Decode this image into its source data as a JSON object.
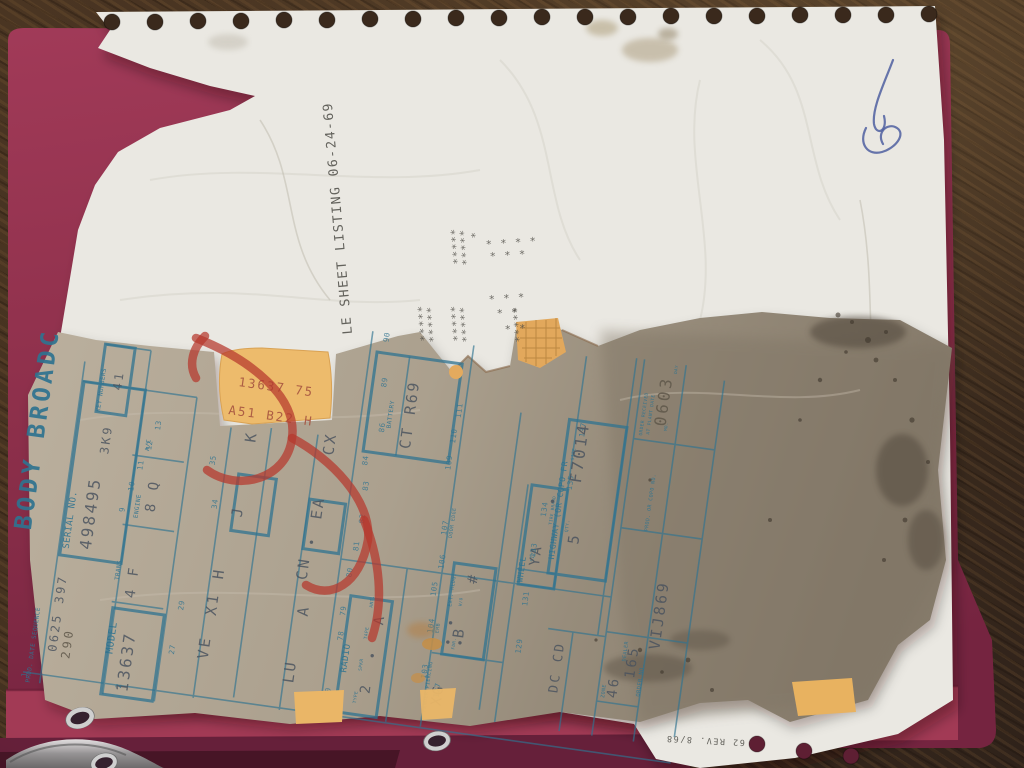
{
  "colors": {
    "wood": "#42301f",
    "folder": "#96334f",
    "folder_flap": "#a23a55",
    "folder_dark": "#66203a",
    "folder_deep": "#471526",
    "paper": "#eae8e2",
    "sheet": "#b9ae9c",
    "sheet_soiled": "#857a6a",
    "grid_blue": "#2f7390",
    "stamp_ink": "#49525e",
    "pencil": "#5f574a",
    "type_ink": "#4c4b45",
    "red_mark": "#b5372c",
    "orange_tag": "#edbb6c",
    "tag_ink": "#a5523f",
    "pen_blue": "#4f5fa0"
  },
  "document": {
    "type_line": "LE SHEET LISTING  06-24-69",
    "title_visible": "BODY BROADC",
    "serial_no": "498495",
    "key_numbers": "3K9 41",
    "prod_date_sequence": "0625 397",
    "model": "13637",
    "trans": "4 F",
    "engine": "8 Q",
    "battery": "CT R69",
    "radio": "2 A",
    "fender_piercing": "XG",
    "emb": "B",
    "wheel_size": "YA",
    "highway_qty": "5",
    "highway_size": "F7014",
    "order_received_date": "0603",
    "order_no": "VIJ869",
    "zone": "46",
    "dealer": "165",
    "dealer_code": "DC CD",
    "orange_tag_line1": "13637 75",
    "orange_tag_line2": "A51 B22 H",
    "form_revision": "62 REV. 8/68"
  },
  "items": [
    {
      "g": "s",
      "t": "BODY BROADC",
      "x": 34,
      "y": 575,
      "s": 24,
      "r": -90,
      "c": "t",
      "ls": 4,
      "n": "sheet-title"
    },
    {
      "g": "s",
      "t": "SERIAL NO.",
      "x": 74,
      "y": 588,
      "s": 9,
      "r": -90,
      "c": "l",
      "ls": 1,
      "n": "serial-label"
    },
    {
      "g": "s",
      "t": "498495",
      "x": 96,
      "y": 586,
      "s": 16,
      "r": -90,
      "c": "s",
      "ls": 12,
      "n": "serial-value"
    },
    {
      "g": "s",
      "t": "KEY NUMBERS",
      "x": 86,
      "y": 448,
      "s": 6,
      "r": -90,
      "c": "l"
    },
    {
      "g": "s",
      "t": "3K9",
      "x": 100,
      "y": 489,
      "s": 12,
      "r": -90,
      "c": "s",
      "ls": 6
    },
    {
      "g": "s",
      "t": "41",
      "x": 104,
      "y": 424,
      "s": 12,
      "r": -90,
      "c": "s",
      "ls": 6
    },
    {
      "g": "s",
      "t": "PROD. DATE SEQUENCE",
      "x": 54,
      "y": 726,
      "s": 6,
      "r": -90,
      "c": "l"
    },
    {
      "g": "s",
      "t": "0625 397",
      "x": 76,
      "y": 692,
      "s": 12,
      "r": -90,
      "c": "s",
      "ls": 7
    },
    {
      "g": "s",
      "t": "290",
      "x": 90,
      "y": 697,
      "s": 12,
      "r": -90,
      "c": "p"
    },
    {
      "g": "s",
      "t": "MODEL",
      "x": 132,
      "y": 686,
      "s": 10,
      "r": -90,
      "c": "l",
      "ls": 1.5,
      "n": "model-label"
    },
    {
      "g": "s",
      "t": "13637",
      "x": 152,
      "y": 722,
      "s": 16,
      "r": -90,
      "c": "s",
      "ls": 12,
      "n": "model-value"
    },
    {
      "g": "s",
      "t": "TRANS",
      "x": 128,
      "y": 612,
      "s": 6,
      "r": -90,
      "c": "l"
    },
    {
      "g": "s",
      "t": "4 F",
      "x": 146,
      "y": 628,
      "s": 14,
      "r": -90,
      "c": "s",
      "ls": 8
    },
    {
      "g": "s",
      "t": "ENGINE",
      "x": 138,
      "y": 548,
      "s": 6,
      "r": -90,
      "c": "l"
    },
    {
      "g": "s",
      "t": "8 Q",
      "x": 154,
      "y": 540,
      "s": 14,
      "r": -90,
      "c": "s",
      "ls": 8
    },
    {
      "g": "s",
      "t": "A/C",
      "x": 140,
      "y": 480,
      "s": 6,
      "r": -90,
      "c": "l"
    },
    {
      "g": "s",
      "t": "9",
      "x": 124,
      "y": 544,
      "s": 7.5,
      "r": -90,
      "c": "n"
    },
    {
      "g": "s",
      "t": "10",
      "x": 130,
      "y": 522,
      "s": 7.5,
      "r": -90,
      "c": "n"
    },
    {
      "g": "s",
      "t": "11",
      "x": 136,
      "y": 500,
      "s": 7.5,
      "r": -90,
      "c": "n"
    },
    {
      "g": "s",
      "t": "12",
      "x": 142,
      "y": 479,
      "s": 7.5,
      "r": -90,
      "c": "n"
    },
    {
      "g": "s",
      "t": "13",
      "x": 148,
      "y": 458,
      "s": 7.5,
      "r": -90,
      "c": "n"
    },
    {
      "g": "s",
      "t": "1",
      "x": 50,
      "y": 721,
      "s": 7.5,
      "r": -90,
      "c": "n"
    },
    {
      "g": "s",
      "t": "2",
      "x": 145,
      "y": 719,
      "s": 7.5,
      "r": -90,
      "c": "n"
    },
    {
      "g": "s",
      "t": "27",
      "x": 193,
      "y": 678,
      "s": 7.5,
      "r": -90,
      "c": "n"
    },
    {
      "g": "s",
      "t": "29",
      "x": 196,
      "y": 633,
      "s": 7.5,
      "r": -90,
      "c": "n"
    },
    {
      "g": "s",
      "t": "34",
      "x": 215,
      "y": 528,
      "s": 7.5,
      "r": -90,
      "c": "n"
    },
    {
      "g": "s",
      "t": "35",
      "x": 207,
      "y": 485,
      "s": 7.5,
      "r": -90,
      "c": "n"
    },
    {
      "g": "s",
      "t": "VE",
      "x": 227,
      "y": 678,
      "s": 15,
      "r": -90,
      "c": "s",
      "ls": 6
    },
    {
      "g": "s",
      "t": "X1",
      "x": 229,
      "y": 634,
      "s": 15,
      "r": -90,
      "c": "s",
      "ls": 6
    },
    {
      "g": "s",
      "t": "H",
      "x": 231,
      "y": 597,
      "s": 15,
      "r": -90,
      "c": "s"
    },
    {
      "g": "s",
      "t": "J",
      "x": 241,
      "y": 533,
      "s": 15,
      "r": -90,
      "c": "s"
    },
    {
      "g": "s",
      "t": "K",
      "x": 244,
      "y": 457,
      "s": 15,
      "r": -90,
      "c": "s"
    },
    {
      "g": "s",
      "t": "LU",
      "x": 315,
      "y": 690,
      "s": 15,
      "r": -90,
      "c": "s",
      "ls": 6
    },
    {
      "g": "s",
      "t": "A",
      "x": 320,
      "y": 622,
      "s": 15,
      "r": -90,
      "c": "s"
    },
    {
      "g": "s",
      "t": "CN",
      "x": 314,
      "y": 586,
      "s": 15,
      "r": -90,
      "c": "s",
      "ls": 6
    },
    {
      "g": "s",
      "t": "•",
      "x": 318,
      "y": 551,
      "s": 12,
      "r": -90,
      "c": "s"
    },
    {
      "g": "s",
      "t": "EA",
      "x": 320,
      "y": 524,
      "s": 15,
      "r": -90,
      "c": "s",
      "ls": 6
    },
    {
      "g": "s",
      "t": "CX",
      "x": 323,
      "y": 459,
      "s": 15,
      "r": -90,
      "c": "s",
      "ls": 6
    },
    {
      "g": "s",
      "t": "BATTERY",
      "x": 376,
      "y": 424,
      "s": 6,
      "r": -90,
      "c": "l"
    },
    {
      "g": "s",
      "t": "CT R69",
      "x": 398,
      "y": 442,
      "s": 15,
      "r": -90,
      "c": "s",
      "ls": 5,
      "n": "battery-value"
    },
    {
      "g": "s",
      "t": "90",
      "x": 362,
      "y": 339,
      "s": 7.5,
      "r": -90,
      "c": "n"
    },
    {
      "g": "s",
      "t": "89",
      "x": 366,
      "y": 384,
      "s": 7.5,
      "r": -90,
      "c": "n"
    },
    {
      "g": "s",
      "t": "86",
      "x": 370,
      "y": 429,
      "s": 7.5,
      "r": -90,
      "c": "n"
    },
    {
      "g": "s",
      "t": "84",
      "x": 358,
      "y": 464,
      "s": 7.5,
      "r": -90,
      "c": "n"
    },
    {
      "g": "s",
      "t": "83",
      "x": 362,
      "y": 489,
      "s": 7.5,
      "r": -90,
      "c": "n"
    },
    {
      "g": "s",
      "t": "82",
      "x": 363,
      "y": 522,
      "s": 7.5,
      "r": -90,
      "c": "n"
    },
    {
      "g": "s",
      "t": "81",
      "x": 361,
      "y": 550,
      "s": 7.5,
      "r": -90,
      "c": "n"
    },
    {
      "g": "s",
      "t": "80",
      "x": 358,
      "y": 577,
      "s": 7.5,
      "r": -90,
      "c": "n"
    },
    {
      "g": "s",
      "t": "79",
      "x": 357,
      "y": 616,
      "s": 7.5,
      "r": -90,
      "c": "n"
    },
    {
      "g": "s",
      "t": "78",
      "x": 358,
      "y": 641,
      "s": 7.5,
      "r": -90,
      "c": "n"
    },
    {
      "g": "s",
      "t": "70",
      "x": 353,
      "y": 699,
      "s": 7.5,
      "r": -90,
      "c": "n"
    },
    {
      "g": "s",
      "t": "111",
      "x": 444,
      "y": 404,
      "s": 7.5,
      "r": -90,
      "c": "n"
    },
    {
      "g": "s",
      "t": "110",
      "x": 442,
      "y": 430,
      "s": 7.5,
      "r": -90,
      "c": "n"
    },
    {
      "g": "s",
      "t": "109",
      "x": 441,
      "y": 457,
      "s": 7.5,
      "r": -90,
      "c": "n"
    },
    {
      "g": "s",
      "t": "107",
      "x": 446,
      "y": 522,
      "s": 7.5,
      "r": -90,
      "c": "n"
    },
    {
      "g": "s",
      "t": "106",
      "x": 448,
      "y": 556,
      "s": 7.5,
      "r": -90,
      "c": "n"
    },
    {
      "g": "s",
      "t": "105",
      "x": 444,
      "y": 584,
      "s": 7.5,
      "r": -90,
      "c": "n"
    },
    {
      "g": "s",
      "t": "104",
      "x": 446,
      "y": 621,
      "s": 7.5,
      "r": -90,
      "c": "n"
    },
    {
      "g": "s",
      "t": "103",
      "x": 446,
      "y": 667,
      "s": 7.5,
      "r": -90,
      "c": "n"
    },
    {
      "g": "s",
      "t": "DOOR EDGE",
      "x": 452,
      "y": 524,
      "s": 5,
      "r": -90,
      "c": "l"
    },
    {
      "g": "s",
      "t": "RADIO",
      "x": 366,
      "y": 672,
      "s": 9,
      "r": -90,
      "c": "l",
      "ls": 1.5,
      "n": "radio-label"
    },
    {
      "g": "s",
      "t": "TYPE",
      "x": 380,
      "y": 701,
      "s": 4.5,
      "r": -90,
      "c": "l"
    },
    {
      "g": "s",
      "t": "SPKR",
      "x": 381,
      "y": 668,
      "s": 4.5,
      "r": -90,
      "c": "l"
    },
    {
      "g": "s",
      "t": "TAPE",
      "x": 382,
      "y": 636,
      "s": 4.5,
      "r": -90,
      "c": "l"
    },
    {
      "g": "s",
      "t": "ANT.",
      "x": 383,
      "y": 604,
      "s": 4.5,
      "r": -90,
      "c": "l"
    },
    {
      "g": "s",
      "t": "2",
      "x": 392,
      "y": 690,
      "s": 14,
      "r": -90,
      "c": "s"
    },
    {
      "g": "s",
      "t": "•",
      "x": 394,
      "y": 655,
      "s": 12,
      "r": -90,
      "c": "s"
    },
    {
      "g": "s",
      "t": "A",
      "x": 396,
      "y": 620,
      "s": 14,
      "r": -90,
      "c": "s"
    },
    {
      "g": "s",
      "t": "FENDER PIERCING",
      "x": 450,
      "y": 700,
      "s": 5,
      "r": -90,
      "c": "l"
    },
    {
      "g": "s",
      "t": "XG",
      "x": 464,
      "y": 692,
      "s": 14,
      "r": -90,
      "c": "s",
      "ls": 6
    },
    {
      "g": "s",
      "t": "• •",
      "x": 467,
      "y": 631,
      "s": 12,
      "r": -90,
      "c": "s",
      "ls": 6
    },
    {
      "g": "s",
      "t": "EMB",
      "x": 452,
      "y": 620,
      "s": 5,
      "r": -90,
      "c": "l"
    },
    {
      "g": "s",
      "t": "B",
      "x": 477,
      "y": 622,
      "s": 15,
      "r": -90,
      "c": "s"
    },
    {
      "g": "s",
      "t": "EXT. MLDG.",
      "x": 461,
      "y": 592,
      "s": 5,
      "r": -90,
      "c": "l"
    },
    {
      "g": "s",
      "t": "FDR.",
      "x": 470,
      "y": 634,
      "s": 4.2,
      "r": -90,
      "c": "l"
    },
    {
      "g": "s",
      "t": "W/O",
      "x": 471,
      "y": 590,
      "s": 4.2,
      "r": -90,
      "c": "l"
    },
    {
      "g": "s",
      "t": "•",
      "x": 479,
      "y": 630,
      "s": 12,
      "r": -90,
      "c": "s"
    },
    {
      "g": "s",
      "t": "#",
      "x": 483,
      "y": 566,
      "s": 14,
      "r": -90,
      "c": "s"
    },
    {
      "g": "s",
      "t": "WHEEL",
      "x": 528,
      "y": 558,
      "s": 8,
      "r": -90,
      "c": "l",
      "ls": 1
    },
    {
      "g": "s",
      "t": "SIZE",
      "x": 536,
      "y": 536,
      "s": 4.5,
      "r": -90,
      "c": "l"
    },
    {
      "g": "s",
      "t": "YA",
      "x": 542,
      "y": 540,
      "s": 14,
      "r": -90,
      "c": "s",
      "ls": 6
    },
    {
      "g": "s",
      "t": "TIRE BRAND",
      "x": 549,
      "y": 497,
      "s": 4.2,
      "r": -90,
      "c": "l"
    },
    {
      "g": "s",
      "t": "•",
      "x": 551,
      "y": 477,
      "s": 12,
      "r": -90,
      "c": "s"
    },
    {
      "g": "s",
      "t": "137",
      "x": 569,
      "y": 406,
      "s": 7.5,
      "r": -90,
      "c": "n"
    },
    {
      "g": "s",
      "t": "135",
      "x": 564,
      "y": 460,
      "s": 7.5,
      "r": -90,
      "c": "n"
    },
    {
      "g": "s",
      "t": "134",
      "x": 542,
      "y": 490,
      "s": 7.5,
      "r": -90,
      "c": "n"
    },
    {
      "g": "s",
      "t": "133",
      "x": 537,
      "y": 532,
      "s": 7.5,
      "r": -90,
      "c": "n"
    },
    {
      "g": "s",
      "t": "131",
      "x": 536,
      "y": 581,
      "s": 7.5,
      "r": -90,
      "c": "n"
    },
    {
      "g": "s",
      "t": "129",
      "x": 536,
      "y": 629,
      "s": 7.5,
      "r": -90,
      "c": "n"
    },
    {
      "g": "s",
      "t": "127",
      "x": 461,
      "y": 684,
      "s": 7.5,
      "r": -90,
      "c": "n"
    },
    {
      "g": "s",
      "t": "HIGHWAY (OR COPO FR",
      "x": 556,
      "y": 531,
      "s": 8,
      "r": -90,
      "c": "l",
      "n": "highway-label"
    },
    {
      "g": "s",
      "t": "QTY.",
      "x": 566,
      "y": 502,
      "s": 4.5,
      "r": -90,
      "c": "l"
    },
    {
      "g": "s",
      "t": "5",
      "x": 578,
      "y": 513,
      "s": 15,
      "r": -90,
      "c": "s"
    },
    {
      "g": "s",
      "t": "SIZE",
      "x": 562,
      "y": 430,
      "s": 4.5,
      "r": -90,
      "c": "l"
    },
    {
      "g": "s",
      "t": "F7014",
      "x": 572,
      "y": 452,
      "s": 16,
      "r": -90,
      "c": "s",
      "ls": 12,
      "n": "highway-size-value"
    },
    {
      "g": "s",
      "t": "ORDER RECEIVED",
      "x": 626,
      "y": 396,
      "s": 4.5,
      "r": -90,
      "c": "l"
    },
    {
      "g": "s",
      "t": "AT PLANT DATE",
      "x": 633,
      "y": 394,
      "s": 4.5,
      "r": -90,
      "c": "l"
    },
    {
      "g": "s",
      "t": "MO.",
      "x": 650,
      "y": 388,
      "s": 4.2,
      "r": -90,
      "c": "l"
    },
    {
      "g": "s",
      "t": "DAY",
      "x": 652,
      "y": 330,
      "s": 4.2,
      "r": -90,
      "c": "l"
    },
    {
      "g": "s",
      "t": "0603",
      "x": 648,
      "y": 384,
      "s": 16,
      "r": -90,
      "c": "p",
      "ls": 8,
      "n": "order-date-value"
    },
    {
      "g": "s",
      "t": "PROD. OR COPO NO.",
      "x": 645,
      "y": 490,
      "s": 5,
      "r": -90,
      "c": "l"
    },
    {
      "g": "s",
      "t": "ORDER NO.",
      "x": 660,
      "y": 655,
      "s": 5.5,
      "r": -90,
      "c": "l"
    },
    {
      "g": "s",
      "t": "VIJ869",
      "x": 673,
      "y": 606,
      "s": 15,
      "r": -90,
      "c": "s",
      "ls": 12,
      "n": "order-number-value"
    },
    {
      "g": "s",
      "t": "ZONE",
      "x": 625,
      "y": 661,
      "s": 5,
      "r": -90,
      "c": "l"
    },
    {
      "g": "s",
      "t": "46",
      "x": 637,
      "y": 660,
      "s": 14,
      "r": -90,
      "c": "s",
      "ls": 8
    },
    {
      "g": "s",
      "t": "DEALER",
      "x": 641,
      "y": 622,
      "s": 5,
      "r": -90,
      "c": "l"
    },
    {
      "g": "s",
      "t": "165",
      "x": 652,
      "y": 638,
      "s": 14,
      "r": -90,
      "c": "s",
      "ls": 8
    },
    {
      "g": "s",
      "t": "DC CD",
      "x": 578,
      "y": 663,
      "s": 13,
      "r": -90,
      "c": "s",
      "ls": 6
    },
    {
      "g": "p",
      "t": "LE SHEET LISTING  06-24-69",
      "x": 352,
      "y": 334,
      "s": 13,
      "r": -95,
      "c": "t2",
      "n": "listing-type-line"
    },
    {
      "g": "p",
      "t": "62 REV. 8/68",
      "x": 745,
      "y": 740,
      "s": 8.5,
      "r": 183,
      "c": "t2",
      "n": "form-revision"
    },
    {
      "g": "p",
      "t": "13637 75",
      "x": 238,
      "y": 386,
      "s": 12.5,
      "r": 8,
      "c": "o",
      "ls": 3,
      "n": "orange-tag-line1"
    },
    {
      "g": "p",
      "t": "A51 B22 H",
      "x": 228,
      "y": 414,
      "s": 12.5,
      "r": 8,
      "c": "o",
      "ls": 3,
      "n": "orange-tag-line2"
    },
    {
      "g": "p",
      "t": "*****",
      "x": 461,
      "y": 264,
      "s": 10.5,
      "r": -95,
      "c": "a"
    },
    {
      "g": "p",
      "t": "*****",
      "x": 470,
      "y": 265,
      "s": 10.5,
      "r": -95,
      "c": "a"
    },
    {
      "g": "p",
      "t": "*",
      "x": 479,
      "y": 238,
      "s": 10.5,
      "r": -95,
      "c": "a"
    },
    {
      "g": "p",
      "t": "*  *  *  *",
      "x": 486,
      "y": 248,
      "s": 10.5,
      "r": -4,
      "c": "a"
    },
    {
      "g": "p",
      "t": "*  *  *",
      "x": 490,
      "y": 260,
      "s": 10.5,
      "r": -4,
      "c": "a"
    },
    {
      "g": "p",
      "t": "*****",
      "x": 428,
      "y": 341,
      "s": 10.5,
      "r": -95,
      "c": "a"
    },
    {
      "g": "p",
      "t": "*****",
      "x": 437,
      "y": 342,
      "s": 10.5,
      "r": -95,
      "c": "a"
    },
    {
      "g": "p",
      "t": "*****",
      "x": 461,
      "y": 341,
      "s": 10.5,
      "r": -95,
      "c": "a"
    },
    {
      "g": "p",
      "t": "*****",
      "x": 470,
      "y": 342,
      "s": 10.5,
      "r": -95,
      "c": "a"
    },
    {
      "g": "p",
      "t": "*****",
      "x": 523,
      "y": 342,
      "s": 10.5,
      "r": -95,
      "c": "a"
    },
    {
      "g": "p",
      "t": "*  *  *",
      "x": 489,
      "y": 303,
      "s": 10.5,
      "r": -4,
      "c": "a"
    },
    {
      "g": "p",
      "t": "* *",
      "x": 497,
      "y": 317,
      "s": 10.5,
      "r": -4,
      "c": "a"
    },
    {
      "g": "p",
      "t": "* *",
      "x": 505,
      "y": 333,
      "s": 10.5,
      "r": -4,
      "c": "a"
    }
  ]
}
